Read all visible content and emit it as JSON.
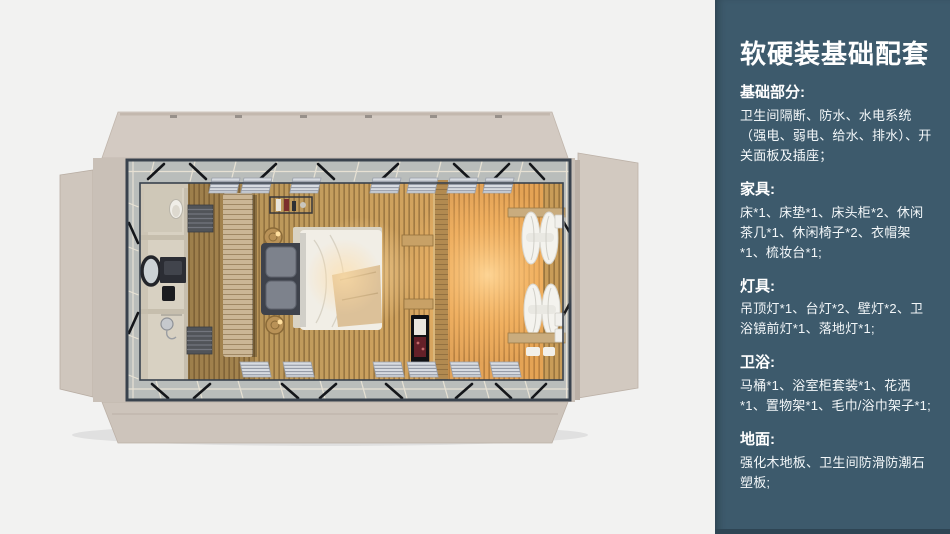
{
  "page": {
    "background": "#f2f2f1",
    "width": 950,
    "height": 534
  },
  "floorplan": {
    "alt": "top-down-render-of-container-guest-room",
    "colors": {
      "shell_beige": "#d0c7be",
      "frame_steel": "#39424d",
      "glass_band": "#b9bdbb",
      "wood_floor": "#c59f60",
      "warm_glow": "#ffc570",
      "bathroom_stone": "#d8d1c2",
      "bed_duvet": "#f1eee6",
      "bed_dark": "#3e424b",
      "curtain_white": "#f4f3ee"
    }
  },
  "sidebar": {
    "background": "#3d5a6c",
    "footer_bar_color": "#2e4554",
    "text_color": "#ffffff",
    "title": "软硬装基础配套",
    "sections": [
      {
        "heading": "基础部分:",
        "body": "卫生间隔断、防水、水电系统（强电、弱电、给水、排水）、开关面板及插座；"
      },
      {
        "heading": "家具:",
        "body": "床*1、床垫*1、床头柜*2、休闲茶几*1、休闲椅子*2、衣帽架*1、梳妆台*1;"
      },
      {
        "heading": "灯具:",
        "body": "吊顶灯*1、台灯*2、壁灯*2、卫浴镜前灯*1、落地灯*1;"
      },
      {
        "heading": "卫浴:",
        "body": "马桶*1、浴室柜套装*1、花洒*1、置物架*1、毛巾/浴巾架子*1;"
      },
      {
        "heading": "地面:",
        "body": "强化木地板、卫生间防滑防潮石塑板;"
      }
    ]
  }
}
